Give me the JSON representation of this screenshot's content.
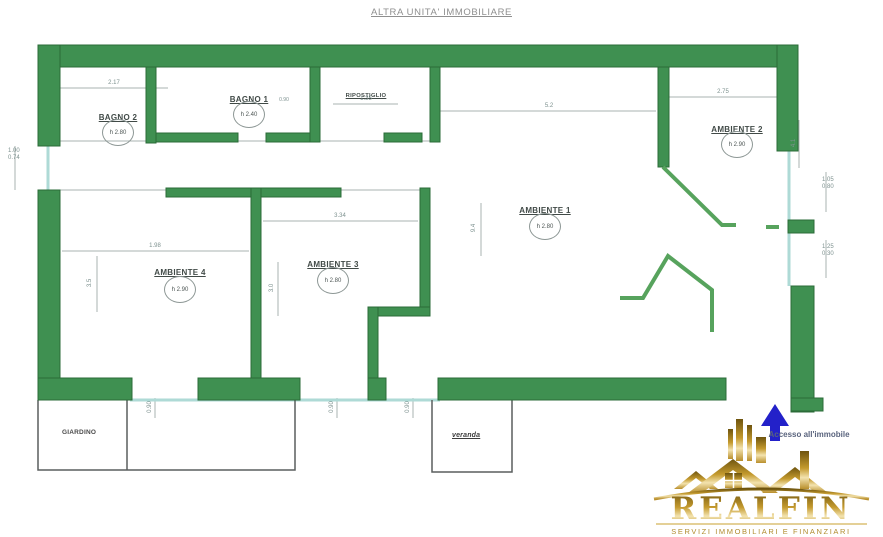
{
  "title": "ALTRA UNITA' IMMOBILIARE",
  "rooms": {
    "bagno2": {
      "name": "BAGNO 2",
      "h": "h 2.80"
    },
    "bagno1": {
      "name": "BAGNO 1",
      "h": "h 2.40"
    },
    "ripostiglio": {
      "name": "RIPOSTIGLIO"
    },
    "ambiente1": {
      "name": "AMBIENTE 1",
      "h": "h 2.80"
    },
    "ambiente2": {
      "name": "AMBIENTE 2",
      "h": "h 2.90"
    },
    "ambiente3": {
      "name": "AMBIENTE 3",
      "h": "h 2.80"
    },
    "ambiente4": {
      "name": "AMBIENTE 4",
      "h": "h 2.90"
    }
  },
  "dims": {
    "top_left": "2.17",
    "rip_width": "1.35",
    "top_center": "5.2",
    "top_right": "2.75",
    "bagno1_door": "0.90",
    "win_left_1": "1.00",
    "win_left_2": "0.74",
    "win_right_a1": "1.05",
    "win_right_a2": "0.80",
    "win_right_b1": "1.25",
    "win_right_b2": "0.30",
    "amb4_top": "1.98",
    "amb3_top": "3.34",
    "amb1_side": "9.4",
    "amb2_side": "4.1",
    "amb4_side": "3.5",
    "amb3_side": "3.0",
    "bottom_1": "0.90",
    "bottom_2": "0.90",
    "bottom_3": "0.90"
  },
  "annexes": {
    "left_label": "GIARDINO",
    "center_label": "veranda"
  },
  "access": {
    "label": "Accesso all'immobile"
  },
  "logo": {
    "brand": "REALFIN",
    "tagline": "SERVIZI IMMOBILIARI E FINANZIARI"
  },
  "colors": {
    "wall": "#3F9051",
    "wall_border": "#2B6B38",
    "thin_wall": "#57A35D",
    "window": "#AEDAD6",
    "dim_text": "#7D918F",
    "arrow": "#2321C9",
    "gold": "#C49A2E"
  }
}
